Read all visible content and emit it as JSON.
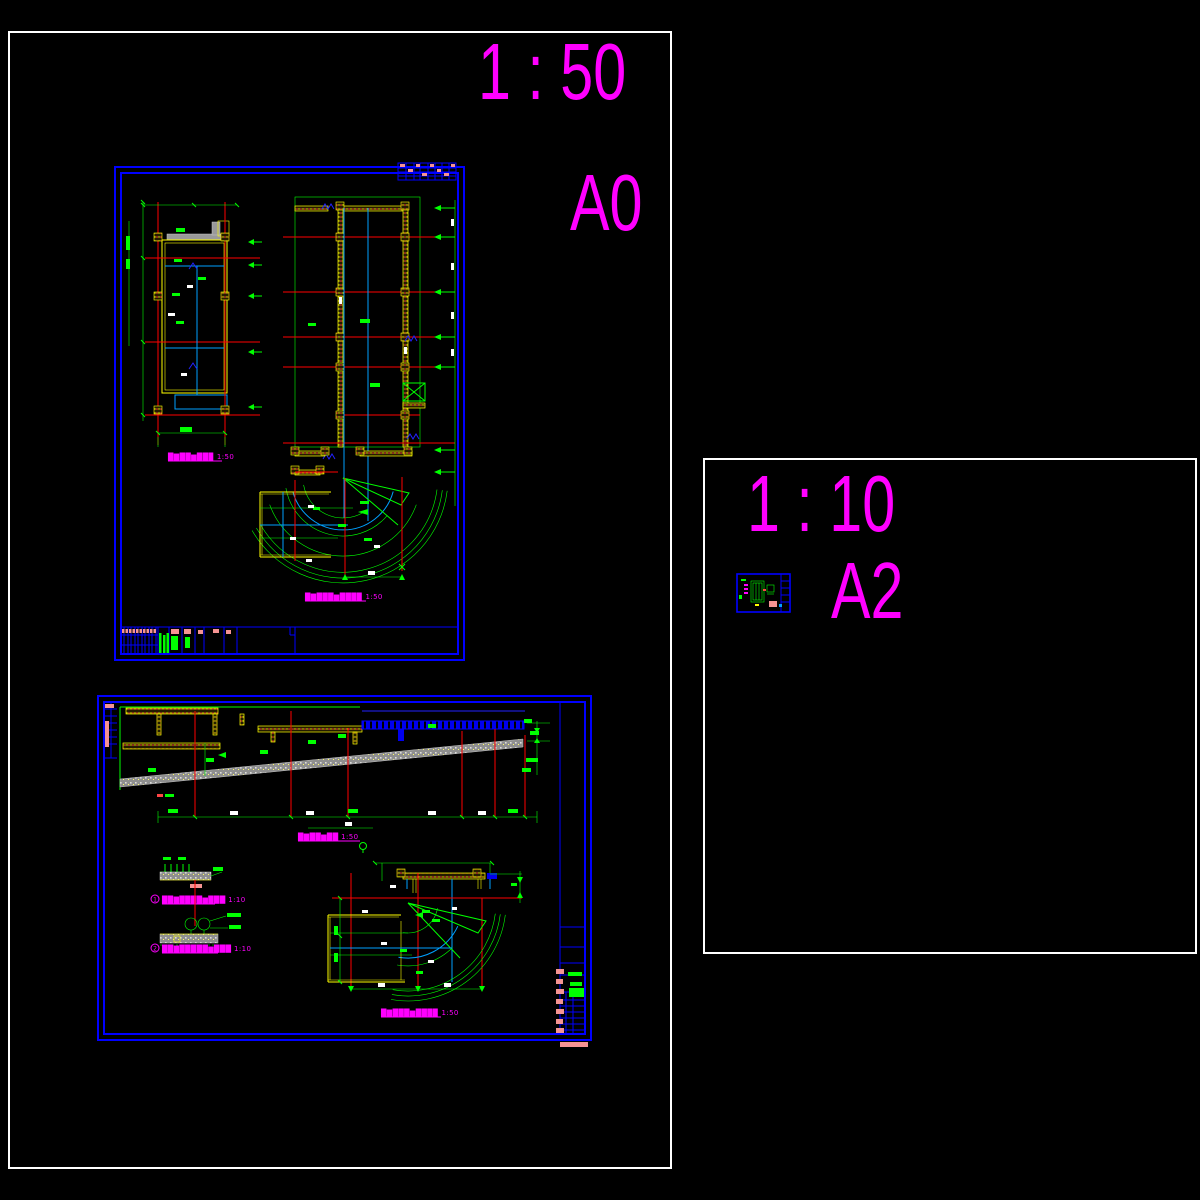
{
  "palette": {
    "background": "#000000",
    "sheet_border": "#ffffff",
    "frame_blue": "#0000ff",
    "cad_green": "#00ff00",
    "cad_red": "#ff0000",
    "cad_yellow": "#ffff00",
    "cad_cyan": "#00a0ff",
    "cad_magenta": "#ff00ff",
    "cad_gray": "#9a9a9a",
    "cad_pink": "#f59393"
  },
  "sheet_a0": {
    "scale_label": "1 : 50",
    "size_label": "A0",
    "frame1": {
      "plan_left_title": "█▇██▆██▉ 1:50",
      "plan_right_title": "█▇███▆███▉ 1:50"
    },
    "frame2": {
      "section_title": "█▇██▆██ 1:50",
      "fan_plan_title": "█▇███▆███▉ 1:50",
      "details": [
        {
          "number": "1",
          "title": "██▇████▆███ 1:10"
        },
        {
          "number": "2",
          "title": "██▇█████▆███ 1:10"
        }
      ]
    }
  },
  "sheet_a2": {
    "scale_label": "1 : 10",
    "size_label": "A2"
  }
}
